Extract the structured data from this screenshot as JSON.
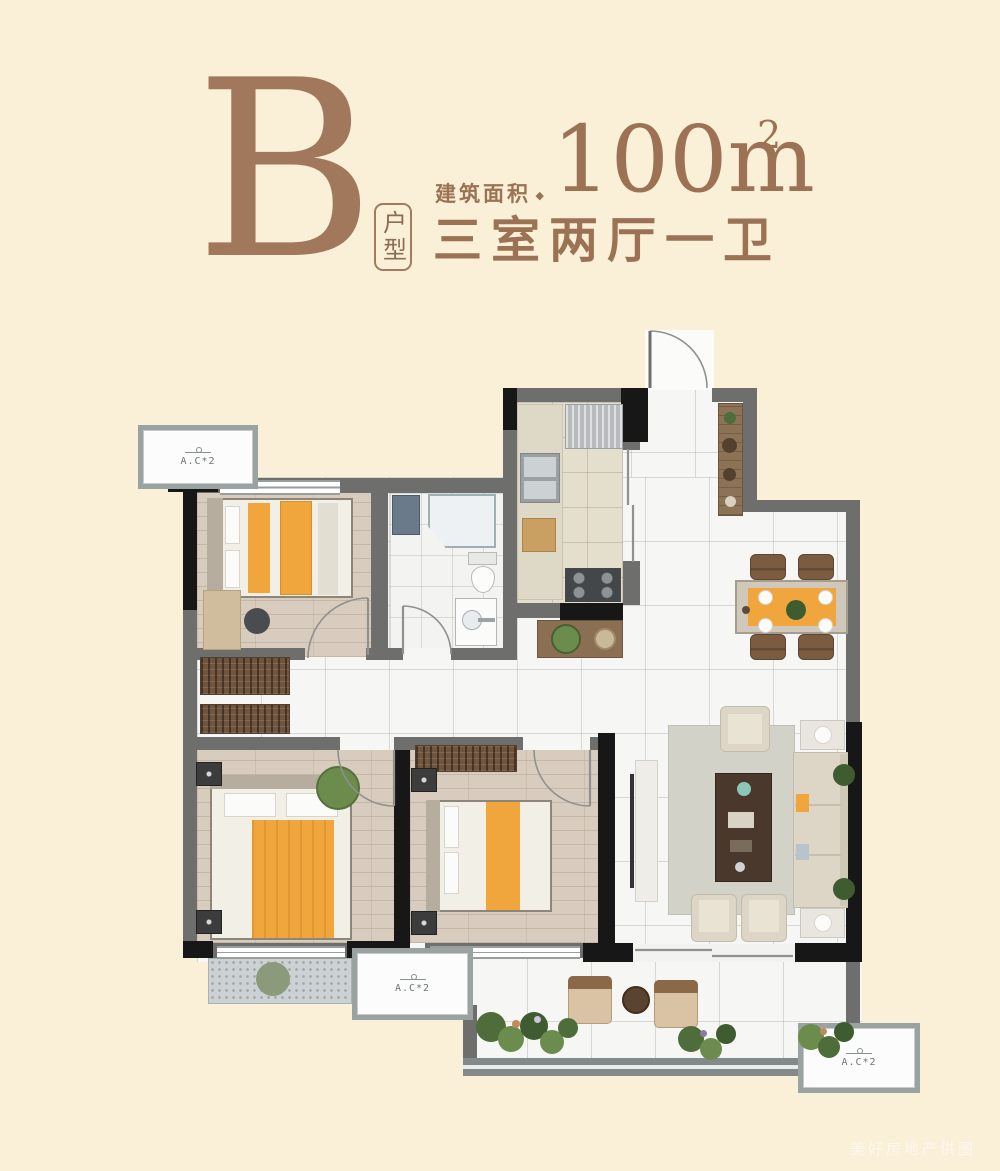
{
  "header": {
    "type_letter": "B",
    "type_badge": "户型",
    "area_label": "建筑面积",
    "area_separator": "◆",
    "area_value": "100m",
    "area_superscript": "2",
    "layout_text": "三室两厅一卫"
  },
  "plan": {
    "ac_labels": [
      "A.C*2",
      "A.C*2",
      "A.C*2"
    ]
  },
  "watermark": "美好房地产供图",
  "colors": {
    "background": "#faf0d8",
    "brand_brown": "#9d7254",
    "accent_orange": "#f0a63c",
    "wall_gray": "#6e6e6d",
    "wall_black": "#171717"
  }
}
